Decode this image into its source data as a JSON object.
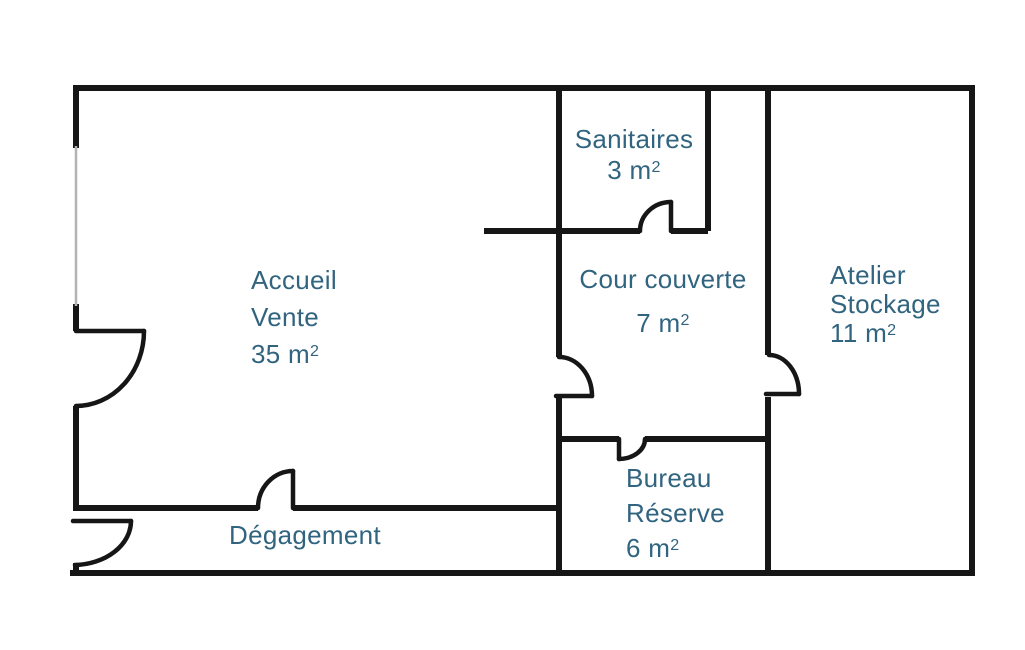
{
  "rooms": {
    "accueil": {
      "name_line1": "Accueil",
      "name_line2": "Vente",
      "area": "35 m²"
    },
    "sanitaires": {
      "name_line1": "Sanitaires",
      "area": "3 m²"
    },
    "cour_couverte": {
      "name_line1": "Cour couverte",
      "area": "7 m²"
    },
    "atelier": {
      "name_line1": "Atelier",
      "name_line2": "Stockage",
      "area": "11 m²"
    },
    "bureau": {
      "name_line1": "Bureau",
      "name_line2": "Réserve",
      "area": "6 m²"
    },
    "degagement": {
      "name_line1": "Dégagement"
    }
  },
  "colors": {
    "wall": "#161616",
    "window_line": "#b3b3b3",
    "label_text": "#31647f",
    "background": "#ffffff"
  }
}
